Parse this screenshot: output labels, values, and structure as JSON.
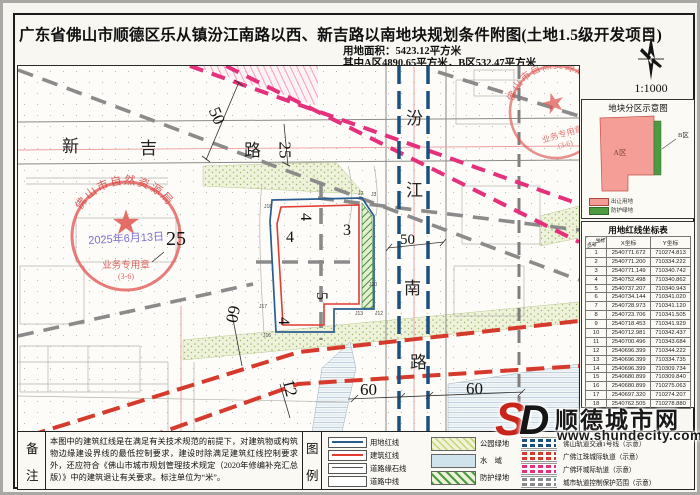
{
  "header": {
    "title": "广东省佛山市顺德区乐从镇汾江南路以西、新吉路以南地块规划条件附图(土地1.5级开发项目)",
    "area_line1": "用地面积：5423.12平方米",
    "area_line2": "其中A区4890.65平方米，B区532.47平方米",
    "north_label": "N",
    "scale": "1:1000"
  },
  "map": {
    "road1": {
      "c0": "新",
      "c1": "吉",
      "c2": "路"
    },
    "road2": {
      "c0": "汾",
      "c1": "江",
      "c2": "南",
      "c3": "路"
    },
    "dims": {
      "w50_top": "50",
      "w25_top": "25",
      "w25_left": "25",
      "w60_left": "60",
      "w12_bottom": "12",
      "w60_bottom1": "60",
      "w60_bottom2": "60",
      "w50_right": "50"
    },
    "setbacks": {
      "top": "4",
      "left": "4",
      "right": "3",
      "mid": "5",
      "bottom": "4"
    },
    "points": {
      "j2": "J2",
      "j3": "J3",
      "j10": "J10",
      "j12": "J12",
      "j13": "J13",
      "j16": "J16",
      "j17": "J17",
      "j18": "J18"
    },
    "stamp": {
      "org": "佛山市自然资源局",
      "seal": "业务专用章",
      "num": "(3-6)",
      "date": "2025年6月13日"
    }
  },
  "panel": {
    "zone_box": {
      "title": "地块分区示意图",
      "a_label": "A区",
      "b_label": "B区",
      "legend_a": "出让用地",
      "legend_b": "防护绿地"
    },
    "coord_table": {
      "title": "用地红线坐标表",
      "corner_top": "坐标",
      "corner_bottom": "点号",
      "col_x": "X坐标",
      "col_y": "Y坐标",
      "rows": [
        [
          "1",
          "2540771.672",
          "710274.813"
        ],
        [
          "2",
          "2540771.200",
          "710334.222"
        ],
        [
          "3",
          "2540771.149",
          "710340.742"
        ],
        [
          "4",
          "2540752.498",
          "710340.862"
        ],
        [
          "5",
          "2540737.207",
          "710340.943"
        ],
        [
          "6",
          "2540734.144",
          "710341.020"
        ],
        [
          "7",
          "2540728.973",
          "710341.120"
        ],
        [
          "8",
          "2540723.706",
          "710341.505"
        ],
        [
          "9",
          "2540718.453",
          "710341.929"
        ],
        [
          "10",
          "2540712.981",
          "710342.437"
        ],
        [
          "11",
          "2540700.496",
          "710343.684"
        ],
        [
          "12",
          "2540696.399",
          "710344.222"
        ],
        [
          "13",
          "2540696.399",
          "710334.735"
        ],
        [
          "14",
          "2540696.399",
          "710309.734"
        ],
        [
          "15",
          "2540680.899",
          "710309.840"
        ],
        [
          "16",
          "2540680.899",
          "710275.063"
        ],
        [
          "17",
          "2540697.320",
          "710274.207"
        ],
        [
          "18",
          "2540762.505",
          "710278.880"
        ]
      ]
    }
  },
  "notes": {
    "label_chars": [
      "备",
      "注"
    ],
    "text": "本图中的建筑红线是在满足有关技术规范的前提下，对建筑物或构筑物边缘建设界线的最低控制要求，建设时除满足建筑红线控制要求外，还应符合《佛山市城市规划管理技术规定（2020年修编补充汇总版）》中的建筑退让有关要求。标注单位为“米”。"
  },
  "legend": {
    "label_chars": [
      "图",
      "例"
    ],
    "col1": [
      {
        "name": "用地红线"
      },
      {
        "name": "建筑红线"
      },
      {
        "name": "道路缘石线"
      },
      {
        "name": "道路中线"
      }
    ],
    "col2": [
      {
        "name": "公园绿地"
      },
      {
        "name": "水　域"
      },
      {
        "name": "防护绿地"
      }
    ],
    "col3": [
      {
        "name": "佛山轨道交通1号线（示意）"
      },
      {
        "name": "广佛江珠城际轨道（示意）"
      },
      {
        "name": "广佛环城际轨道（示意）"
      },
      {
        "name": "城市轨道控制保护范围（示意）"
      }
    ]
  },
  "watermark": {
    "s": "S",
    "d": "D",
    "name": "顺德城市网",
    "url": "www.shundecity.com"
  },
  "colors": {
    "parcel_blue": "#2a5d8f",
    "building_red": "#e23c30",
    "metro_blue": "#1b4f7e",
    "intercity_red": "#d63a2c",
    "ring_magenta": "#e5307c",
    "protect_gray": "#8b8b8b",
    "zone_a_pink": "#f59d97",
    "zone_b_green": "#4e9a41",
    "stamp_red": "#dd5c55",
    "park_green": "#dfe8c2",
    "water_blue": "#cfe3ec"
  }
}
